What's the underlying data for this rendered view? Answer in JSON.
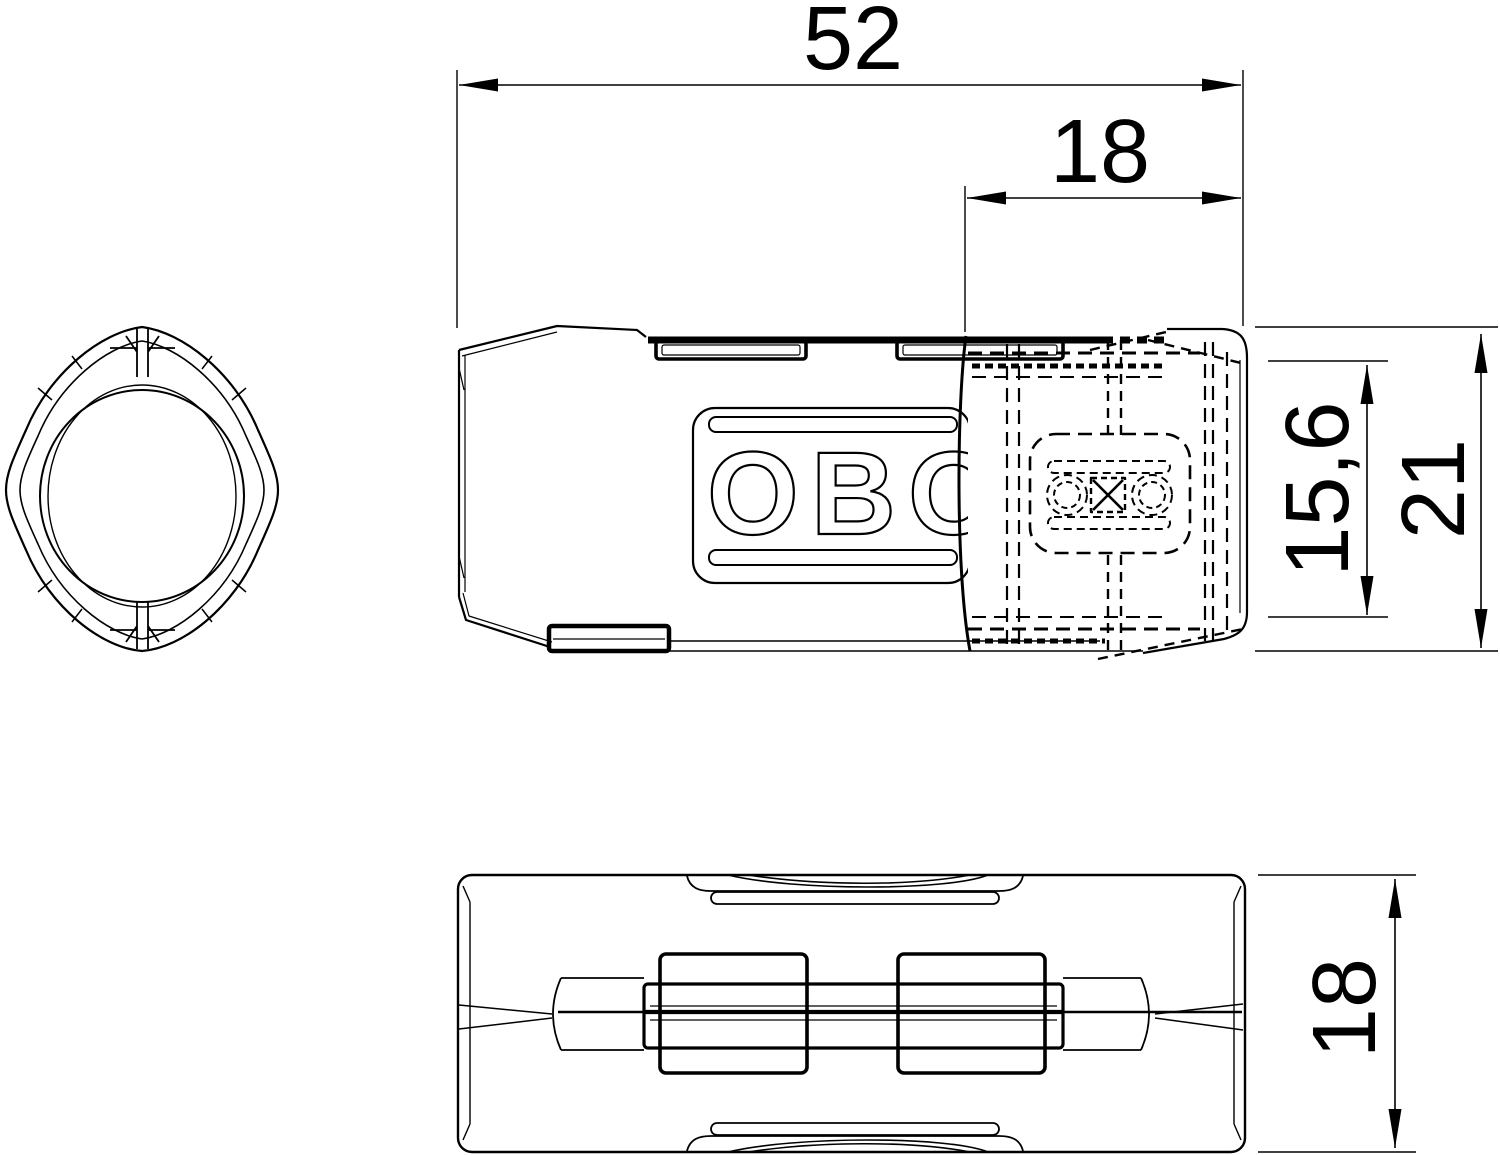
{
  "drawing": {
    "logo_text": "OBO",
    "dimensions": {
      "overall_length": "52",
      "slider_length": "18",
      "clamp_height": "15,6",
      "overall_height": "21",
      "body_width": "18"
    },
    "colors": {
      "ink": "#000000",
      "background": "#ffffff"
    }
  }
}
